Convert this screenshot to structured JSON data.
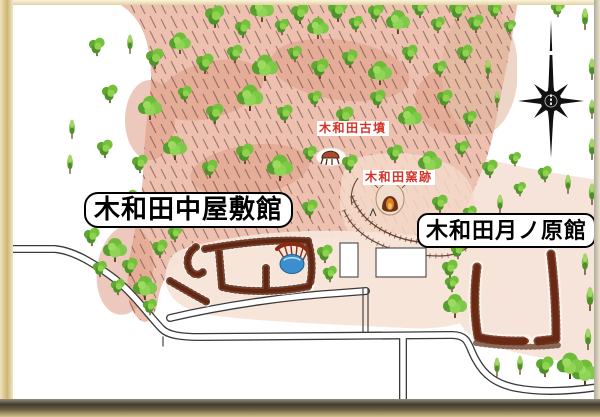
{
  "map": {
    "labels": {
      "kofun_tomb": "木和田古墳",
      "kiln_site": "木和田窯跡",
      "naka_yashiki_castle": "木和田中屋敷館",
      "tsukinohara_castle": "木和田月ノ原館"
    },
    "colors": {
      "hill_pink": "#edc0b0",
      "pale_ground": "#f7e3d7",
      "tree_green": "#6fbc3a",
      "earthwork_brown": "#953818",
      "pond_blue": "#3c8ecf",
      "small_label_red": "#d53227",
      "frame_tan": "#cdb673",
      "road_outline": "#3a3a3a"
    },
    "compass": {
      "icon": "compass-rose"
    }
  }
}
